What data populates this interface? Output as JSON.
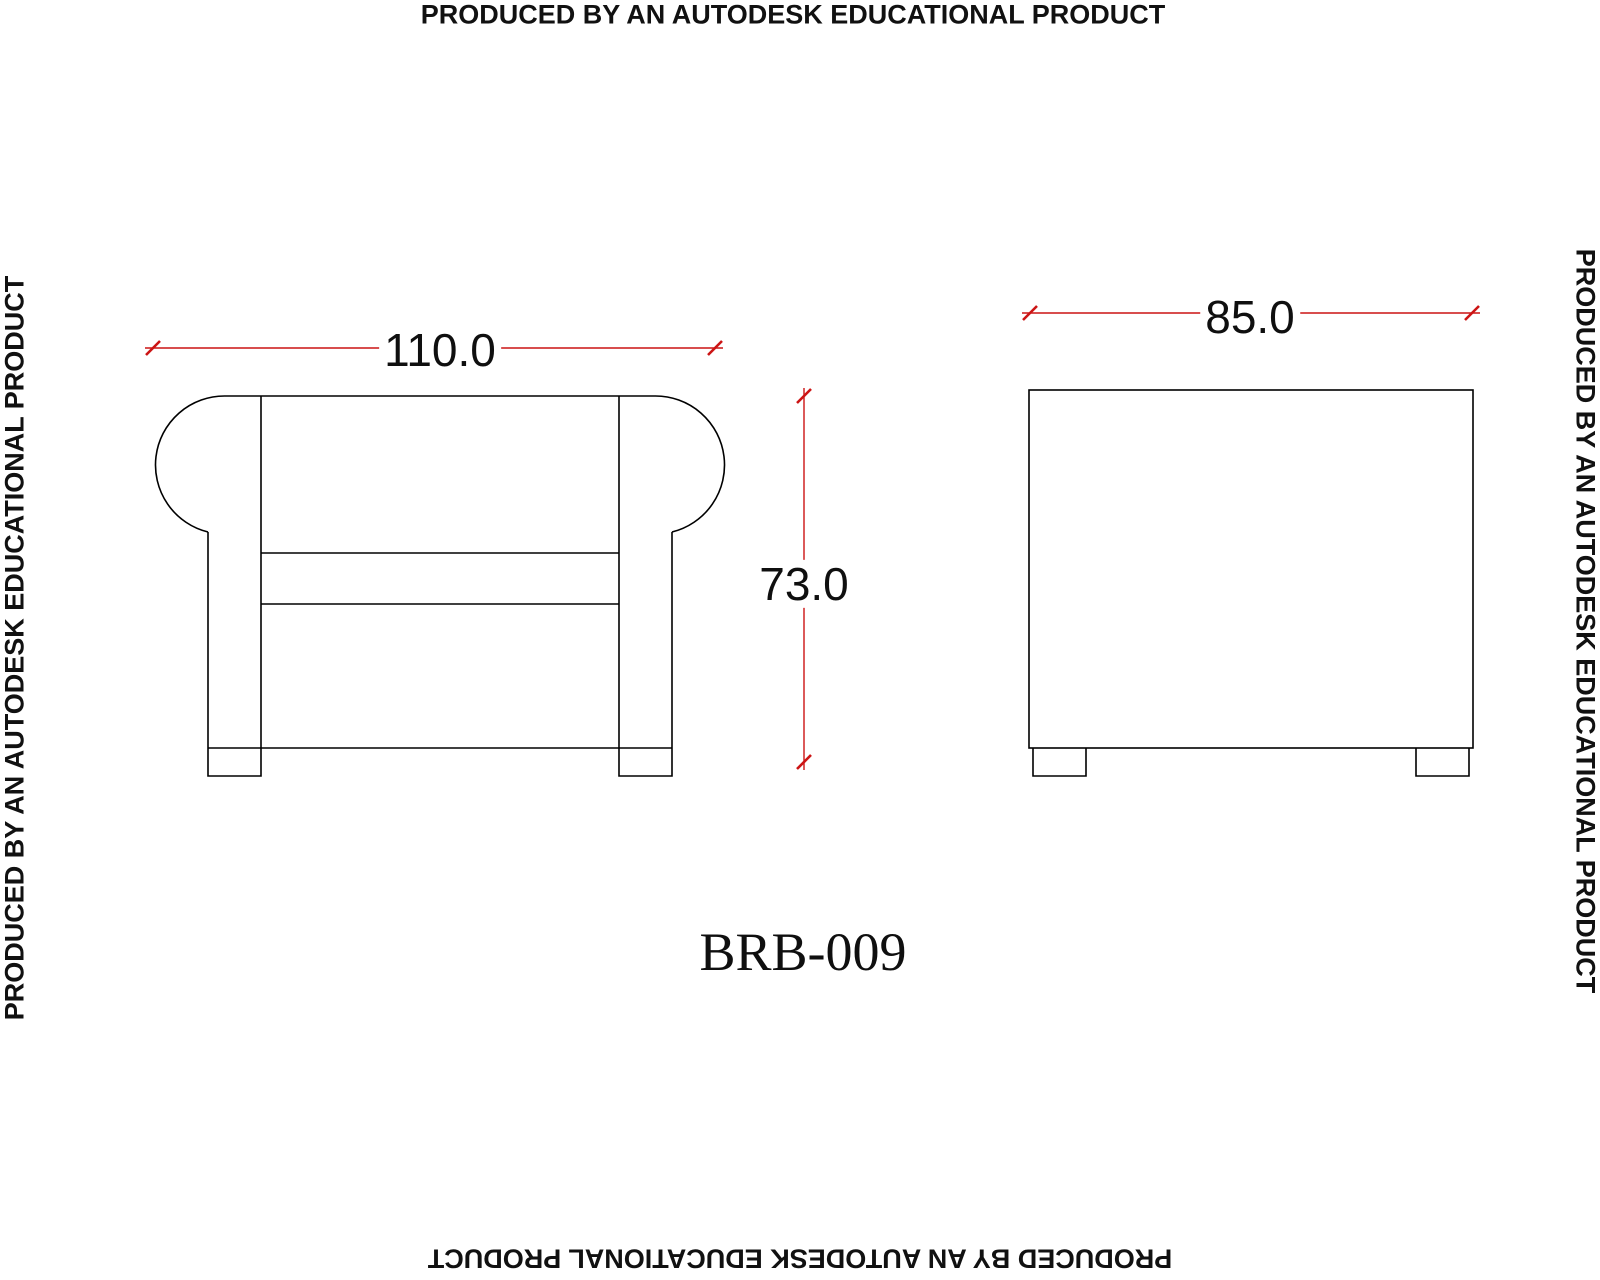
{
  "drawing": {
    "title": "BRB-009",
    "watermark_text": "PRODUCED BY AN AUTODESK EDUCATIONAL PRODUCT",
    "views": {
      "front": {
        "label": "front-elevation",
        "width_dim": "110.0",
        "height_dim": "73.0"
      },
      "side": {
        "label": "side-elevation",
        "depth_dim": "85.0"
      }
    },
    "colors": {
      "dimension_red": "#cc1414",
      "line_black": "#000000",
      "background": "#ffffff"
    }
  }
}
